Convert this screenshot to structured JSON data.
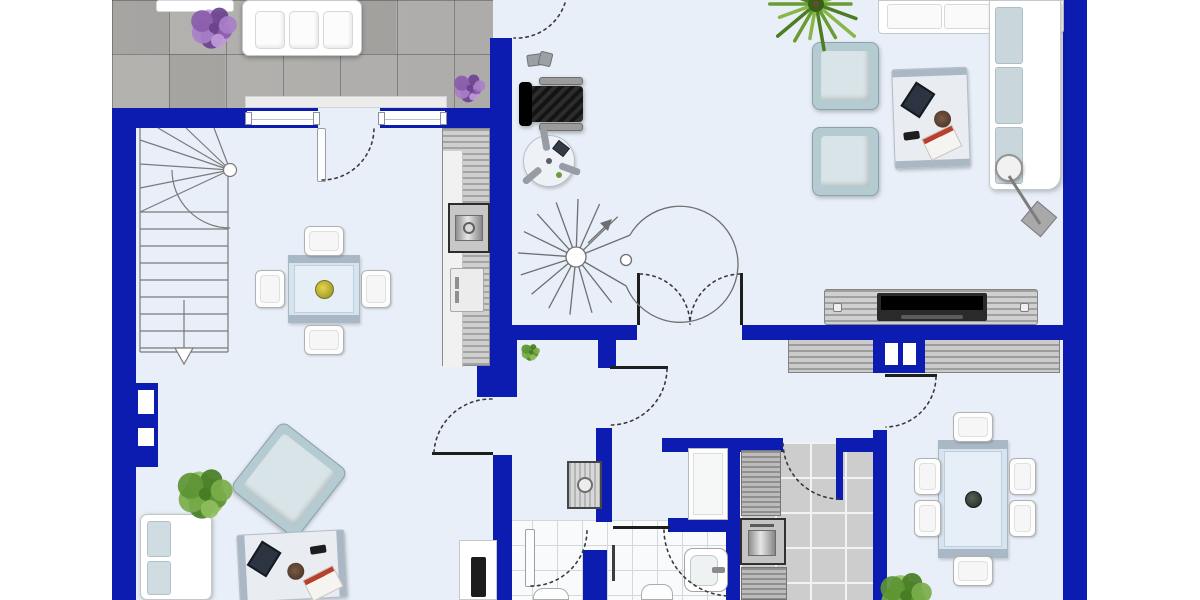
{
  "meta": {
    "title": "ground-floor-plan",
    "canvas": {
      "w": 1200,
      "h": 600
    }
  },
  "palette": {
    "wall_blue": "#0c1cb0",
    "floor_light": "#e9eff8",
    "terrace_gray": "#b0aeac",
    "bath_tile": "#f8fafb",
    "kitchen_tile": "#cdcdcd",
    "cushion_blue": "#b4cbd2",
    "furniture_white": "#ffffff",
    "counter_gray": "#a3a3a3",
    "accent_plant_green": "#5d9433",
    "accent_flower_purple": "#8a5cab"
  },
  "elements": [
    {
      "name": "interior-floor",
      "kind": "base-floor",
      "x": 136,
      "y": 0,
      "w": 927,
      "h": 600
    },
    {
      "name": "terrace-floor",
      "kind": "terrace-floor",
      "x": 112,
      "y": 0,
      "w": 381,
      "h": 108
    },
    {
      "name": "terrace-tile-dark",
      "kind": "tile-dark",
      "x": 169,
      "y": 54,
      "w": 56,
      "h": 54
    },
    {
      "name": "terrace-tile-dark",
      "kind": "tile-dark",
      "x": 340,
      "y": 0,
      "w": 56,
      "h": 54
    },
    {
      "name": "terrace-tile-dark",
      "kind": "tile-dark",
      "x": 112,
      "y": 0,
      "w": 57,
      "h": 54
    },
    {
      "name": "window-sill-outside",
      "kind": "sill",
      "x": 245,
      "y": 96,
      "w": 202,
      "h": 12
    },
    {
      "name": "bathroom-floor",
      "kind": "bath-floor",
      "x": 507,
      "y": 520,
      "w": 231,
      "h": 80
    },
    {
      "name": "kitchen-floor",
      "kind": "kitchen-floor",
      "x": 740,
      "y": 442,
      "w": 135,
      "h": 158
    },
    {
      "name": "sideboard-dining",
      "kind": "sideboard",
      "x": 788,
      "y": 337,
      "w": 272,
      "h": 36
    },
    {
      "name": "wall-outer-left",
      "kind": "wall",
      "x": 112,
      "y": 108,
      "w": 24,
      "h": 492
    },
    {
      "name": "wall-niche-block",
      "kind": "wall-niche-block",
      "x": 136,
      "y": 383,
      "w": 22,
      "h": 84
    },
    {
      "name": "wall-top-left",
      "kind": "wall",
      "x": 112,
      "y": 108,
      "w": 135,
      "h": 20
    },
    {
      "name": "wall-top-mid",
      "kind": "wall",
      "x": 445,
      "y": 108,
      "w": 67,
      "h": 20
    },
    {
      "name": "wall-center-vertical",
      "kind": "wall",
      "x": 490,
      "y": 38,
      "w": 22,
      "h": 302
    },
    {
      "name": "wall-hall-top",
      "kind": "wall",
      "x": 490,
      "y": 325,
      "w": 147,
      "h": 15
    },
    {
      "name": "wall-living-bottom",
      "kind": "wall",
      "x": 742,
      "y": 325,
      "w": 345,
      "h": 15
    },
    {
      "name": "wall-hall-stub",
      "kind": "wall",
      "x": 598,
      "y": 340,
      "w": 18,
      "h": 28
    },
    {
      "name": "wall-pillar-hall",
      "kind": "wall",
      "x": 477,
      "y": 340,
      "w": 40,
      "h": 57
    },
    {
      "name": "wall-hall-west",
      "kind": "wall",
      "x": 493,
      "y": 455,
      "w": 19,
      "h": 145
    },
    {
      "name": "wall-bath-left",
      "kind": "wall",
      "x": 596,
      "y": 428,
      "w": 16,
      "h": 94
    },
    {
      "name": "wall-wc",
      "kind": "wall",
      "x": 583,
      "y": 550,
      "w": 24,
      "h": 50
    },
    {
      "name": "wall-bath-mid",
      "kind": "wall",
      "x": 668,
      "y": 518,
      "w": 70,
      "h": 14
    },
    {
      "name": "wall-kitchen-left",
      "kind": "wall",
      "x": 726,
      "y": 438,
      "w": 14,
      "h": 162
    },
    {
      "name": "wall-kitchen-top",
      "kind": "wall",
      "x": 662,
      "y": 438,
      "w": 121,
      "h": 14
    },
    {
      "name": "wall-kitchen-top-2",
      "kind": "wall",
      "x": 843,
      "y": 438,
      "w": 32,
      "h": 14
    },
    {
      "name": "wall-dining-left",
      "kind": "wall",
      "x": 873,
      "y": 430,
      "w": 14,
      "h": 170
    },
    {
      "name": "chimney",
      "kind": "chimney",
      "x": 873,
      "y": 337,
      "w": 52,
      "h": 36
    },
    {
      "name": "wall-outer-right",
      "kind": "wall",
      "x": 1063,
      "y": 0,
      "w": 24,
      "h": 600
    },
    {
      "name": "window-dining-left",
      "kind": "window",
      "x": 247,
      "y": 108,
      "w": 71,
      "h": 20
    },
    {
      "name": "window-dining-right",
      "kind": "window",
      "x": 380,
      "y": 108,
      "w": 65,
      "h": 20
    },
    {
      "name": "terrace-planter",
      "kind": "terrace-planter",
      "x": 156,
      "y": 0,
      "w": 78,
      "h": 12
    },
    {
      "name": "terrace-sofa",
      "kind": "terrace-sofa",
      "x": 242,
      "y": 0,
      "w": 120,
      "h": 56
    },
    {
      "name": "desk-chair",
      "kind": "desk-chair",
      "x": 519,
      "y": 77,
      "w": 67,
      "h": 54
    },
    {
      "name": "desk-clutter",
      "kind": "side-items",
      "x": 527,
      "y": 52,
      "w": 26,
      "h": 16
    },
    {
      "name": "fan-table",
      "kind": "round-table",
      "x": 523,
      "y": 135,
      "w": 52,
      "h": 52
    },
    {
      "name": "kitchen-counter-long",
      "kind": "kitchen-counter",
      "x": 442,
      "y": 128,
      "w": 48,
      "h": 238
    },
    {
      "name": "oven",
      "kind": "oven",
      "x": 448,
      "y": 203,
      "w": 42,
      "h": 50
    },
    {
      "name": "sink-cabinet",
      "kind": "sink-cab",
      "x": 450,
      "y": 268,
      "w": 34,
      "h": 44
    },
    {
      "name": "corner-sofa-top",
      "kind": "lsofa-h",
      "x": 878,
      "y": 0,
      "w": 186,
      "h": 34
    },
    {
      "name": "corner-sofa-right",
      "kind": "lsofa-v",
      "x": 989,
      "y": 0,
      "w": 72,
      "h": 190
    },
    {
      "name": "armchair-living-1",
      "kind": "armchair",
      "x": 812,
      "y": 42,
      "w": 67,
      "h": 68
    },
    {
      "name": "armchair-living-2",
      "kind": "armchair",
      "x": 812,
      "y": 127,
      "w": 67,
      "h": 69
    },
    {
      "name": "coffee-table-living",
      "kind": "coffee-table",
      "x": 893,
      "y": 68,
      "w": 76,
      "h": 100,
      "rot": -2
    },
    {
      "name": "arc-lamp-shade",
      "kind": "lamp-shade",
      "x": 995,
      "y": 154,
      "w": 28,
      "h": 28
    },
    {
      "name": "arc-lamp-base",
      "kind": "lamp-base",
      "x": 1026,
      "y": 206,
      "w": 26,
      "h": 26,
      "rot": 40
    },
    {
      "name": "tv-lowboard",
      "kind": "tv-board",
      "x": 824,
      "y": 289,
      "w": 214,
      "h": 36
    },
    {
      "name": "dining-table-6",
      "kind": "dining-table",
      "x": 938,
      "y": 440,
      "w": 70,
      "h": 118
    },
    {
      "name": "dining-chair-top",
      "kind": "din-chair",
      "x": 953,
      "y": 412,
      "w": 40,
      "h": 30
    },
    {
      "name": "dining-chair-bottom",
      "kind": "din-chair",
      "x": 953,
      "y": 556,
      "w": 40,
      "h": 30
    },
    {
      "name": "dining-chair-left-1",
      "kind": "din-chair",
      "x": 914,
      "y": 458,
      "w": 27,
      "h": 37
    },
    {
      "name": "dining-chair-left-2",
      "kind": "din-chair",
      "x": 914,
      "y": 500,
      "w": 27,
      "h": 37
    },
    {
      "name": "dining-chair-right-1",
      "kind": "din-chair",
      "x": 1009,
      "y": 458,
      "w": 27,
      "h": 37
    },
    {
      "name": "dining-chair-right-2",
      "kind": "din-chair",
      "x": 1009,
      "y": 500,
      "w": 27,
      "h": 37
    },
    {
      "name": "dining-table-4",
      "kind": "dining-table-sm",
      "x": 288,
      "y": 255,
      "w": 72,
      "h": 68
    },
    {
      "name": "dining4-chair-top",
      "kind": "din-chair",
      "x": 304,
      "y": 226,
      "w": 40,
      "h": 30
    },
    {
      "name": "dining4-chair-bottom",
      "kind": "din-chair",
      "x": 304,
      "y": 325,
      "w": 40,
      "h": 30
    },
    {
      "name": "dining4-chair-left",
      "kind": "din-chair",
      "x": 255,
      "y": 270,
      "w": 30,
      "h": 38
    },
    {
      "name": "dining4-chair-right",
      "kind": "din-chair",
      "x": 361,
      "y": 270,
      "w": 30,
      "h": 38
    },
    {
      "name": "shower",
      "kind": "shower",
      "x": 688,
      "y": 448,
      "w": 40,
      "h": 72
    },
    {
      "name": "boiler",
      "kind": "boiler",
      "x": 567,
      "y": 461,
      "w": 35,
      "h": 48
    },
    {
      "name": "washbasin",
      "kind": "basin",
      "x": 684,
      "y": 548,
      "w": 44,
      "h": 44
    },
    {
      "name": "toilet-bath",
      "kind": "toilet",
      "x": 641,
      "y": 584,
      "w": 32,
      "h": 16
    },
    {
      "name": "toilet-wc",
      "kind": "toilet",
      "x": 533,
      "y": 588,
      "w": 36,
      "h": 12
    },
    {
      "name": "shower-glass",
      "kind": "glass-bar",
      "x": 612,
      "y": 545,
      "w": 3,
      "h": 36
    },
    {
      "name": "kitchen-counter-north",
      "kind": "k-counter",
      "x": 741,
      "y": 450,
      "w": 40,
      "h": 66
    },
    {
      "name": "kitchen-oven",
      "kind": "k-oven",
      "x": 740,
      "y": 518,
      "w": 46,
      "h": 47
    },
    {
      "name": "kitchen-counter-south",
      "kind": "k-counter",
      "x": 741,
      "y": 567,
      "w": 46,
      "h": 33
    },
    {
      "name": "tv-stand-living2",
      "kind": "tv-stand",
      "x": 459,
      "y": 540,
      "w": 38,
      "h": 60
    },
    {
      "name": "sofa-living2",
      "kind": "sofa-bl",
      "x": 140,
      "y": 514,
      "w": 72,
      "h": 86
    },
    {
      "name": "armchair-living2",
      "kind": "armchair",
      "x": 247,
      "y": 437,
      "w": 84,
      "h": 86,
      "rot": 38
    },
    {
      "name": "coffee-table-living2",
      "kind": "coffee-table-h",
      "x": 238,
      "y": 532,
      "w": 108,
      "h": 68,
      "rot": -3
    },
    {
      "name": "door-leaf-entry",
      "kind": "door-leaf",
      "x": 317,
      "y": 128,
      "w": 9,
      "h": 54
    },
    {
      "name": "door-leaf-wc",
      "kind": "door-leaf",
      "x": 525,
      "y": 529,
      "w": 10,
      "h": 58
    },
    {
      "name": "door-jamb-double-left",
      "kind": "dark-bar",
      "x": 637,
      "y": 273,
      "w": 3,
      "h": 52
    },
    {
      "name": "door-jamb-double-right",
      "kind": "dark-bar",
      "x": 740,
      "y": 273,
      "w": 3,
      "h": 52
    },
    {
      "name": "door-open-hall-west",
      "kind": "dark-bar",
      "x": 432,
      "y": 452,
      "w": 61,
      "h": 3
    },
    {
      "name": "door-open-bath-north",
      "kind": "dark-bar",
      "x": 610,
      "y": 366,
      "w": 58,
      "h": 3
    },
    {
      "name": "door-open-dining",
      "kind": "dark-bar",
      "x": 885,
      "y": 374,
      "w": 52,
      "h": 3
    },
    {
      "name": "door-threshold-bath",
      "kind": "dark-bar",
      "x": 613,
      "y": 526,
      "w": 57,
      "h": 3
    },
    {
      "name": "door-leaf-kitchen",
      "kind": "wall-bar",
      "x": 836,
      "y": 438,
      "w": 7,
      "h": 62
    }
  ],
  "vectors": {
    "arcs": [
      {
        "name": "door-arc-terrace",
        "d": "M 565,3 A 51 51 0 0 1 514,38"
      },
      {
        "name": "door-arc-entry",
        "d": "M 322,180 A 52 52 0 0 0 374,128"
      },
      {
        "name": "door-arc-hall-west",
        "d": "M 492,399 A 57 57 0 0 0 434,452"
      },
      {
        "name": "door-arc-double-left",
        "d": "M 640,274 A 51 51 0 0 1 690,324"
      },
      {
        "name": "door-arc-double-right",
        "d": "M 740,274 A 51 51 0 0 0 690,324"
      },
      {
        "name": "door-arc-bath-north",
        "d": "M 667,369 A 57 57 0 0 1 611,425"
      },
      {
        "name": "door-arc-wc",
        "d": "M 531,586 A 56 56 0 0 0 587,530"
      },
      {
        "name": "door-arc-bath",
        "d": "M 664,530 A 67 67 0 0 0 730,596"
      },
      {
        "name": "door-arc-kitchen",
        "d": "M 839,499 A 57 57 0 0 1 783,441"
      },
      {
        "name": "door-arc-dining",
        "d": "M 936,377 A 51 51 0 0 1 886,427"
      }
    ],
    "lines": [
      {
        "name": "lamp-rod",
        "x1": 1009,
        "y1": 176,
        "x2": 1040,
        "y2": 224,
        "w": 3,
        "c": "#7d7d7d"
      }
    ],
    "stairs": {
      "name": "staircase-straight",
      "x": 140,
      "y": 128,
      "w": 88,
      "h": 237,
      "pivot": [
        230,
        170
      ]
    },
    "spiral": {
      "name": "staircase-spiral",
      "cx": 576,
      "cy": 257,
      "r": 58
    },
    "plants": [
      {
        "name": "plant-palm-living",
        "type": "palm",
        "cx": 816,
        "cy": 4,
        "r": 50
      },
      {
        "name": "plant-leafy-living2",
        "type": "leafy",
        "cx": 205,
        "cy": 494,
        "r": 31
      },
      {
        "name": "plant-leafy-dining",
        "type": "leafy",
        "cx": 906,
        "cy": 596,
        "r": 29
      },
      {
        "name": "plant-purple-terrace-1",
        "type": "purple",
        "cx": 214,
        "cy": 28,
        "r": 26
      },
      {
        "name": "plant-purple-terrace-2",
        "type": "purple",
        "cx": 470,
        "cy": 88,
        "r": 18
      },
      {
        "name": "plant-deco-hall",
        "type": "leafy",
        "cx": 531,
        "cy": 352,
        "r": 11
      }
    ]
  }
}
